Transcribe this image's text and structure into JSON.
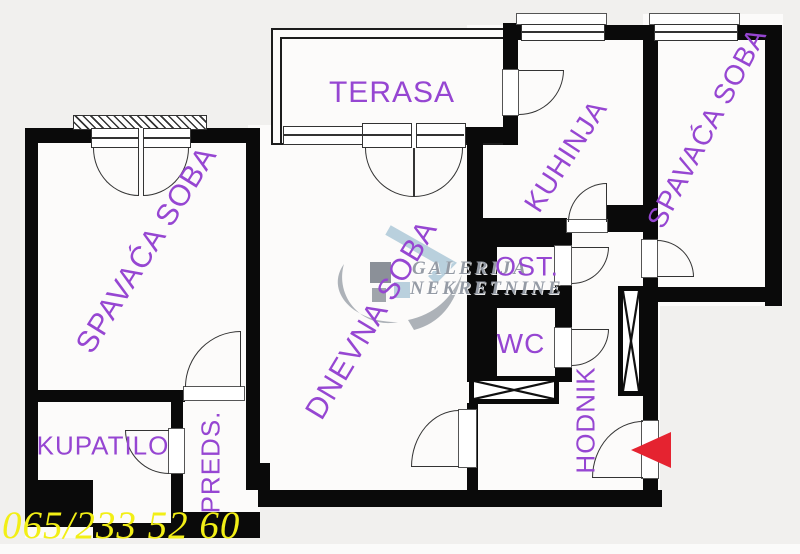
{
  "plan": {
    "title": "apartment-floor-plan",
    "rooms": [
      {
        "id": "terasa",
        "label": "TERASA"
      },
      {
        "id": "spavaca-soba-left",
        "label": "SPAVAĆA SOBA"
      },
      {
        "id": "kuhinja",
        "label": "KUHINJA"
      },
      {
        "id": "spavaca-soba-right",
        "label": "SPAVAĆA SOBA"
      },
      {
        "id": "dnevna-soba",
        "label": "DNEVNA SOBA"
      },
      {
        "id": "ost",
        "label": "OST."
      },
      {
        "id": "wc",
        "label": "WC"
      },
      {
        "id": "kupatilo",
        "label": "KUPATILO"
      },
      {
        "id": "preds",
        "label": "PREDS."
      },
      {
        "id": "hodnik",
        "label": "HODNIK"
      }
    ],
    "watermark": {
      "line1": "GALERIJA",
      "line2": "NEKRETNINE"
    },
    "phone": "065/233 52 60",
    "entrance": {
      "symbol": "red-arrow",
      "direction": "left"
    },
    "colors": {
      "wall": "#0a0a0a",
      "label": "#9646d2",
      "phone": "#f2ef16",
      "arrow": "#e52330",
      "watermark": "#959ba5"
    }
  }
}
